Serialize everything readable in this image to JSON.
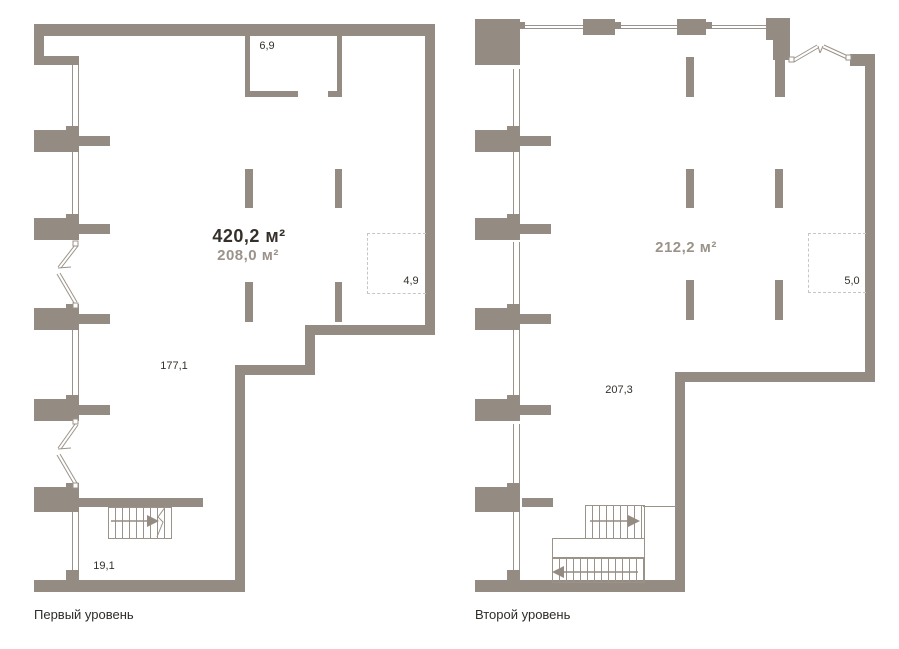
{
  "colors": {
    "wall": "#948c82",
    "thin_line": "#9b9389",
    "dashed_line": "#c9c6c2",
    "text_dark": "#35312b",
    "text_muted": "#9b938a",
    "background": "#ffffff"
  },
  "icons": {
    "stair_arrow_right": "►",
    "stair_arrow_left": "◄"
  },
  "level1": {
    "caption": "Первый уровень",
    "total_area": "420,2 м²",
    "secondary_area": "208,0 м²",
    "labels": {
      "storage_room": "6,9",
      "dashed_zone": "4,9",
      "main_room": "177,1",
      "lower_room": "19,1"
    }
  },
  "level2": {
    "caption": "Второй уровень",
    "total_area": "212,2 м²",
    "labels": {
      "dashed_zone": "5,0",
      "main_room": "207,3"
    }
  }
}
